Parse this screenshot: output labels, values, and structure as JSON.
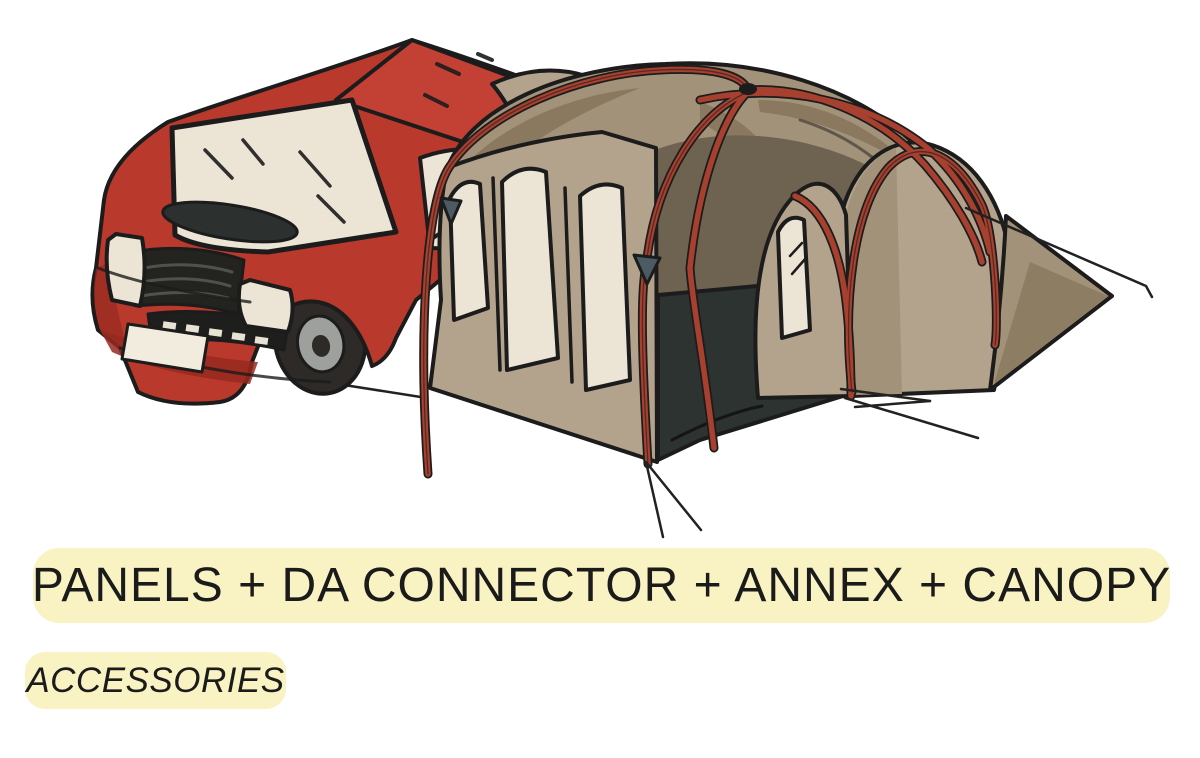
{
  "page": {
    "background": "#ffffff"
  },
  "banners": {
    "main": {
      "label": "PANELS + DA CONNECTOR + ANNEX + CANOPY",
      "bg": "#F9F2C2",
      "text_color": "#1b1b1b"
    },
    "sub": {
      "label": "ACCESSORIES",
      "bg": "#F9F2C2",
      "text_color": "#1b1b1b"
    }
  },
  "illustration": {
    "alt": "Red camper van with attached drive-away awning: panel windows, connector tunnel, annex and canopy",
    "colors": {
      "page_bg": "#ffffff",
      "banner_yellow": "#F9F2C2",
      "banner_text": "#1b1b1b",
      "outline": "#1c1c1c",
      "van_red": "#b93a2d",
      "van_red_dark": "#97291f",
      "van_red_roof": "#c24134",
      "window_cream": "#ece5d6",
      "tent_tan": "#b3a28c",
      "tent_tan_mid": "#a3927a",
      "tent_tan_dark": "#8a795f",
      "tent_inner": "#6e6350",
      "doorway_dark": "#2c3331",
      "pole_red": "#a8402f",
      "tire_dark": "#2d2a27",
      "hub_gray": "#9da09c",
      "clip_gray": "#4b5a63",
      "grille_dark": "#23241f"
    }
  }
}
